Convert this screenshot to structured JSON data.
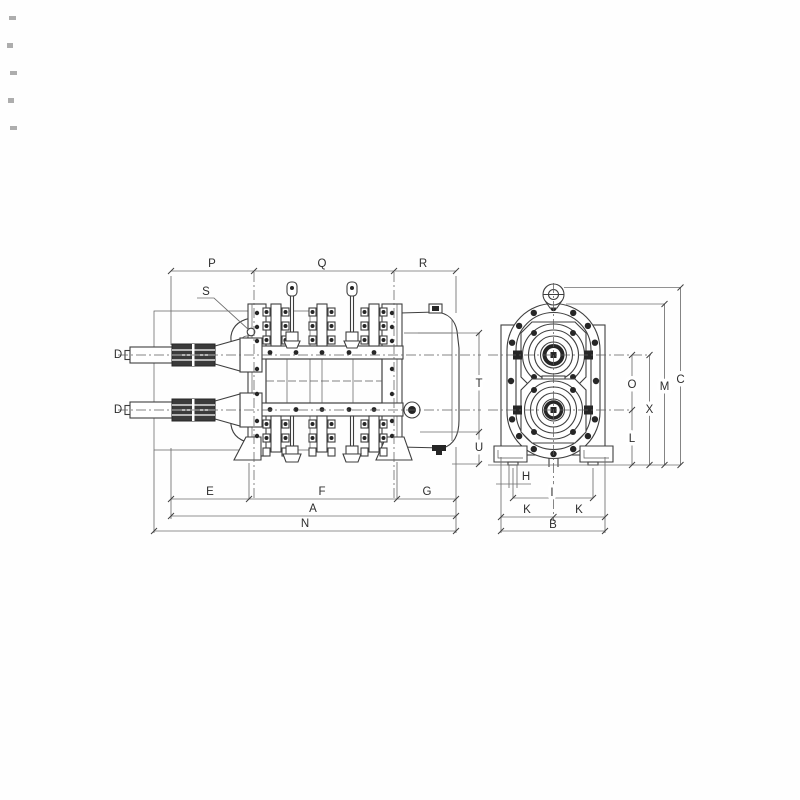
{
  "labels": {
    "P": "P",
    "Q": "Q",
    "R": "R",
    "S": "S",
    "D_top": "D",
    "D_bottom": "D",
    "T": "T",
    "U": "U",
    "E": "E",
    "F": "F",
    "G": "G",
    "A": "A",
    "N": "N",
    "O": "O",
    "X": "X",
    "L": "L",
    "M": "M",
    "C": "C",
    "H": "H",
    "I": "I",
    "K_left": "K",
    "K_right": "K",
    "B": "B"
  },
  "colors": {
    "line": "#3f3f3f",
    "dimension_line": "#6e6e6e",
    "text": "#2e2e2e",
    "background": "#fefefe"
  }
}
